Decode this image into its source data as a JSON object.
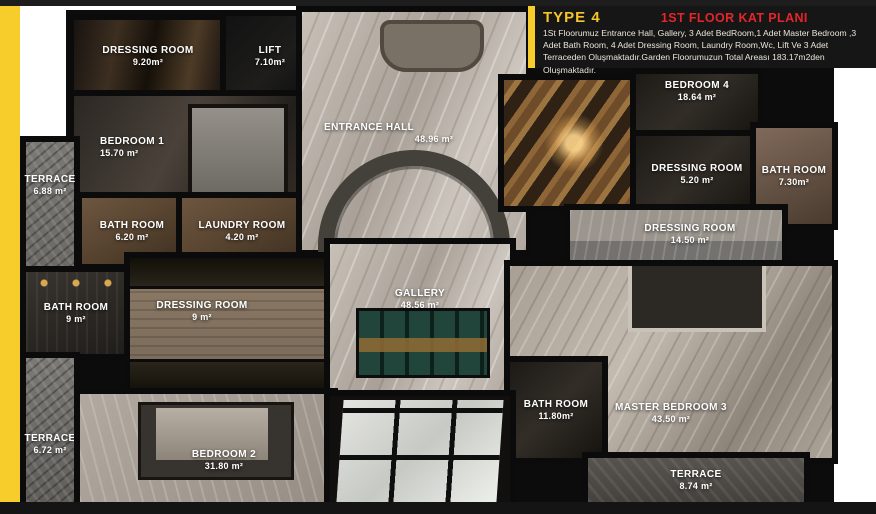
{
  "header": {
    "type_label": "TYPE 4",
    "title": "1ST FLOOR KAT PLANI",
    "description": "1St Floorumuz Entrance Hall, Gallery, 3 Adet BedRoom,1 Adet Master Bedroom ,3 Adet Bath Room, 4 Adet Dressing Room, Laundry Room,Wc, Lift Ve 3 Adet Terraceden Oluşmaktadır.Garden Floorumuzun Total Areası 183.17m2den Oluşmaktadır.",
    "colors": {
      "accent_yellow": "#F7CD2B",
      "title_red": "#E4262B",
      "header_bg": "#161616"
    }
  },
  "rooms": {
    "dressing_room_1": {
      "name": "DRESSING ROOM",
      "area": "9.20m²"
    },
    "lift": {
      "name": "LIFT",
      "area": "7.10m²"
    },
    "bedroom_1": {
      "name": "BEDROOM 1",
      "area": "15.70 m²"
    },
    "terrace_1": {
      "name": "TERRACE",
      "area": "6.88 m²"
    },
    "bath_room_1": {
      "name": "BATH ROOM",
      "area": "6.20 m²"
    },
    "laundry_room": {
      "name": "LAUNDRY ROOM",
      "area": "4.20 m²"
    },
    "entrance_hall": {
      "name": "ENTRANCE HALL",
      "area": "48.96 m²"
    },
    "bedroom_4": {
      "name": "BEDROOM 4",
      "area": "18.64 m²"
    },
    "dressing_room_2": {
      "name": "DRESSING ROOM",
      "area": "5.20 m²"
    },
    "bath_room_2": {
      "name": "BATH ROOM",
      "area": "7.30m²"
    },
    "dressing_room_3": {
      "name": "DRESSING ROOM",
      "area": "14.50 m²"
    },
    "bath_room_4": {
      "name": "BATH ROOM",
      "area": "9 m²"
    },
    "dressing_room_4": {
      "name": "DRESSING ROOM",
      "area": "9 m²"
    },
    "gallery": {
      "name": "GALLERY",
      "area": "48.56 m²"
    },
    "terrace_2": {
      "name": "TERRACE",
      "area": "6.72 m²"
    },
    "bedroom_2": {
      "name": "BEDROOM 2",
      "area": "31.80 m²"
    },
    "bath_room_3": {
      "name": "BATH ROOM",
      "area": "11.80m²"
    },
    "master_bedroom": {
      "name": "MASTER BEDROOM 3",
      "area": "43.50 m²"
    },
    "terrace_3": {
      "name": "TERRACE",
      "area": "8.74 m²"
    }
  }
}
